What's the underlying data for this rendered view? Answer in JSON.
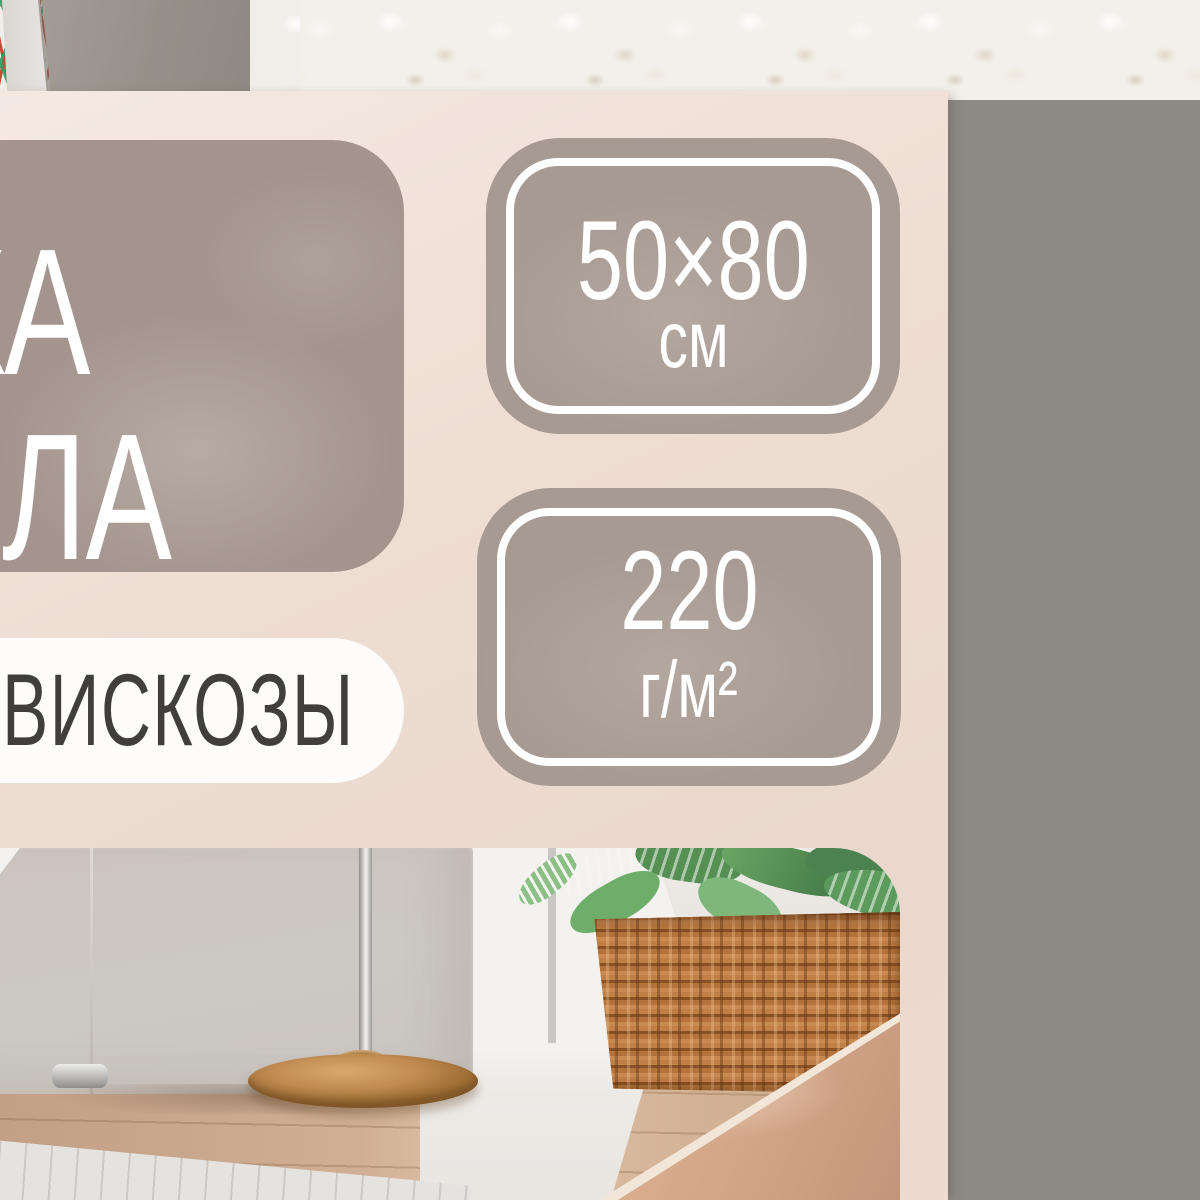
{
  "package": {
    "label": {
      "title_visible_line1": "КА",
      "title_visible_line2": "ОЛА",
      "material_text": "ВИСКОЗЫ",
      "size_badge": {
        "value": "50×80",
        "unit": "см"
      },
      "density_badge": {
        "value": "220",
        "unit": "г/м²"
      }
    },
    "colors": {
      "label_background": "#eedcd2",
      "panel_taupe": "#a79a93",
      "badge_text": "#ffffff",
      "material_text_color": "#413f3e",
      "stitch_red": "#c6412d",
      "stitch_green": "#2f9e62",
      "background_wall": "#8e8981"
    }
  }
}
